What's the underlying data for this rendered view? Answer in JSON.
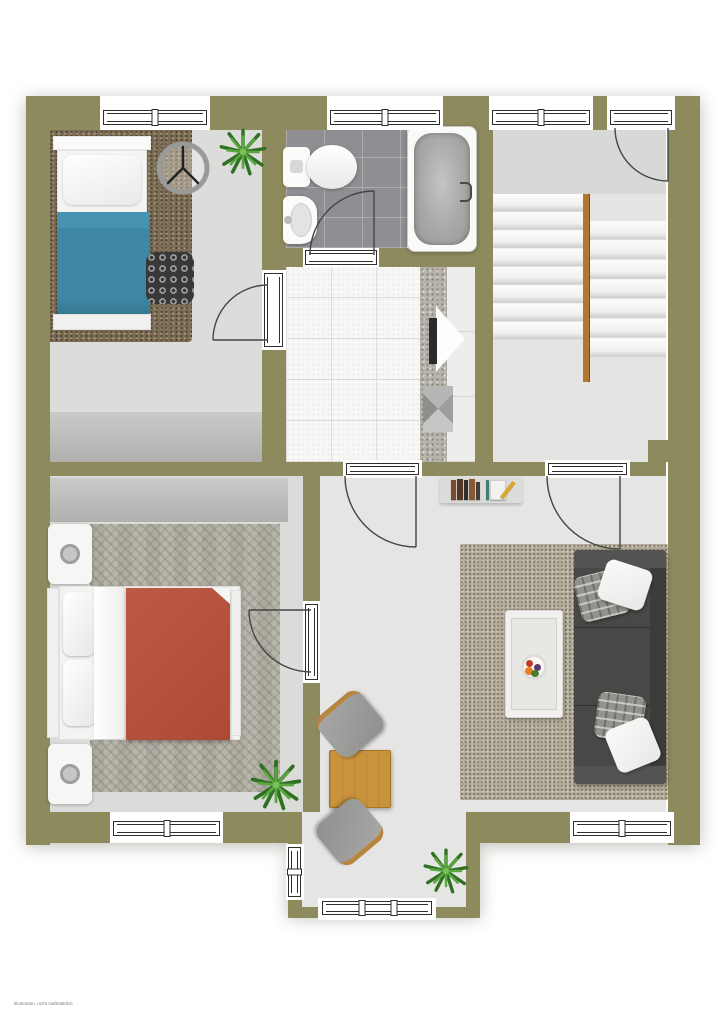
{
  "page": {
    "background": "#ffffff",
    "disclaimer": "Illustration, nicht maßstäblich"
  },
  "plan": {
    "type": "2d-floor-plan-top-view",
    "wall_color": "#8d8a5e",
    "rooms": [
      {
        "name": "bedroom-top-left",
        "floor_color": "#dcdcda",
        "furniture": [
          "single-bed",
          "shag-rug",
          "wall-clock",
          "potted-plant",
          "patterned-pouf",
          "wardrobe"
        ]
      },
      {
        "name": "bathroom",
        "floor_color": "#8f8f93",
        "furniture": [
          "toilet",
          "washbasin",
          "bathtub"
        ]
      },
      {
        "name": "stairwell",
        "floor_color": "#e4e4e2",
        "furniture": [
          "staircase-two-flights",
          "wooden-handrail"
        ]
      },
      {
        "name": "kitchen",
        "floor_color": "#f7f7f5",
        "furniture": [
          "counter",
          "cabinets"
        ]
      },
      {
        "name": "hallway-dining",
        "floor_color": "#e5e5e3",
        "furniture": [
          "bookshelf",
          "dining-table",
          "chair",
          "chair",
          "potted-plant"
        ]
      },
      {
        "name": "bedroom-bottom-left",
        "floor_color": "#dbdbd9",
        "furniture": [
          "double-bed",
          "nightstand",
          "nightstand",
          "herringbone-rug",
          "wardrobe",
          "potted-plant"
        ]
      },
      {
        "name": "living-area",
        "floor_color": "#e5e5e3",
        "furniture": [
          "sofa",
          "pillows",
          "coffee-table",
          "fruit-bowl",
          "textured-rug"
        ]
      }
    ],
    "colors": {
      "single_bed_blanket": "#3e88a6",
      "double_bed_blanket": "#b2513d",
      "sofa": "#4a4846",
      "dining_table_wood": "#c9923c",
      "stair_rail": "#b5762f",
      "plant_green": "#3f8a2f",
      "living_rug": "#b3ab98",
      "shag_rug": "#7d6d55",
      "herringbone_rug": "#b8b5ab"
    },
    "counts": {
      "windows": 7,
      "doors": 6,
      "plants": 3
    }
  }
}
